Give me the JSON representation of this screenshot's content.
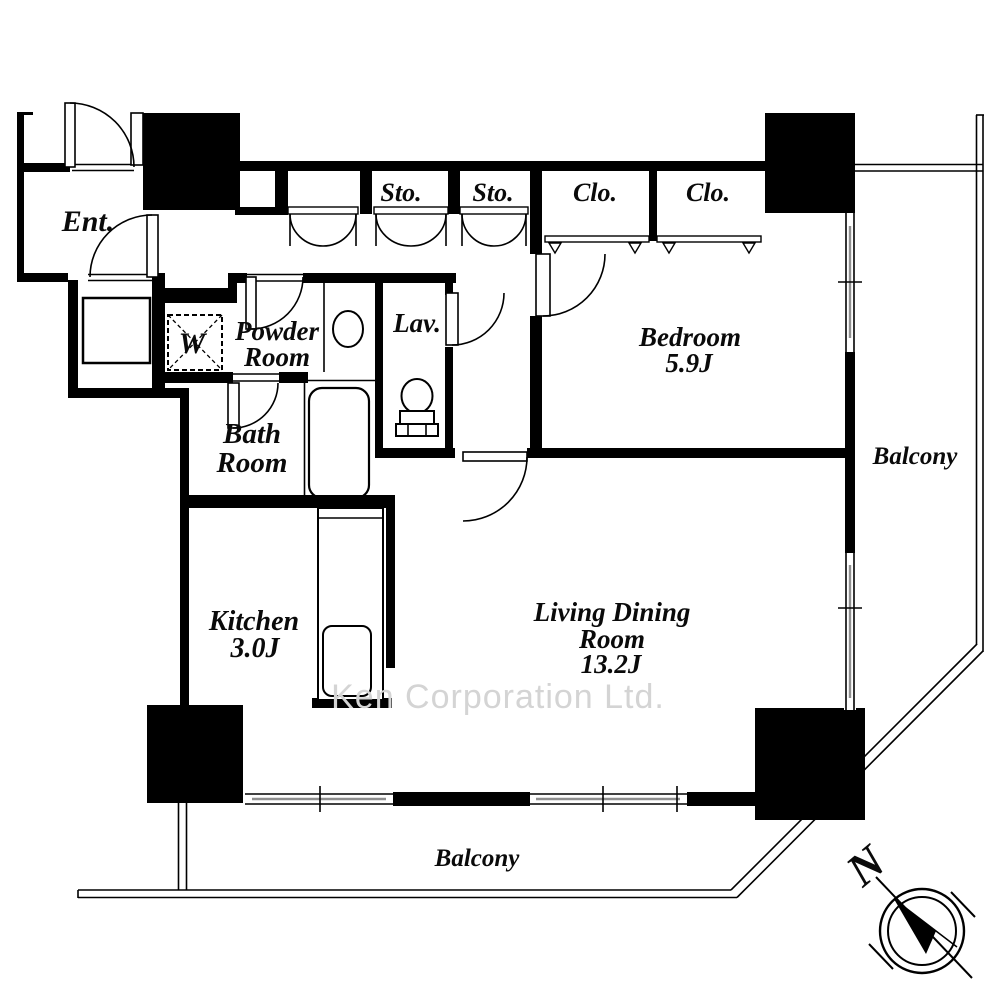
{
  "floorplan": {
    "rooms": {
      "ent": {
        "label": "Ent."
      },
      "powder": {
        "line1": "Powder",
        "line2": "Room"
      },
      "washer": {
        "label": "W"
      },
      "lav": {
        "label": "Lav."
      },
      "bath": {
        "line1": "Bath",
        "line2": "Room"
      },
      "bedroom": {
        "label": "Bedroom",
        "size": "5.9J"
      },
      "kitchen": {
        "label": "Kitchen",
        "size": "3.0J"
      },
      "living": {
        "line1": "Living Dining",
        "line2": "Room",
        "size": "13.2J"
      }
    },
    "storage": {
      "sto1": "Sto.",
      "sto2": "Sto.",
      "clo1": "Clo.",
      "clo2": "Clo."
    },
    "balconies": {
      "right": "Balcony",
      "bottom": "Balcony"
    },
    "compass_label": "N",
    "watermark": "Ken Corporation Ltd.",
    "colors": {
      "wall": "#000000",
      "watermark": "#d4d4d4",
      "window_glass": "#8f8f8f",
      "background": "#ffffff"
    }
  }
}
